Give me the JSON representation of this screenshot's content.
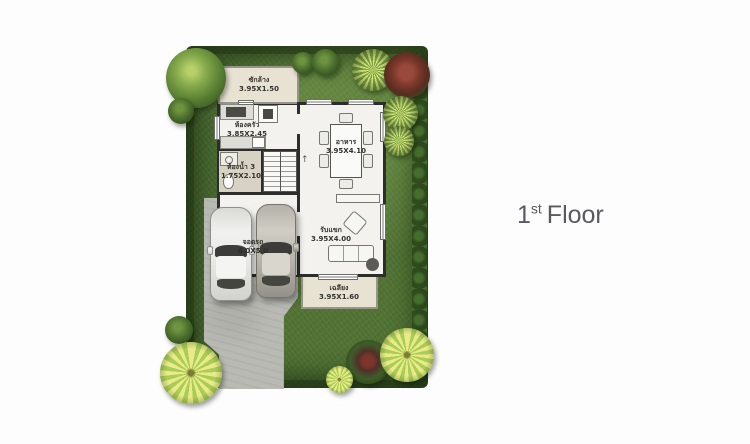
{
  "floor_label": {
    "number": "1",
    "ordinal": "st",
    "word": "Floor"
  },
  "rooms": {
    "laundry": {
      "name": "ซักล้าง",
      "size": "3.95X1.50"
    },
    "kitchen": {
      "name": "ห้องครัว",
      "size": "3.85X2.45"
    },
    "bathroom": {
      "name": "ห้องน้ำ 3",
      "size": "1.75X2.10"
    },
    "dining": {
      "name": "อาหาร",
      "size": "3.95X4.10"
    },
    "living": {
      "name": "รับแขก",
      "size": "3.95X4.00"
    },
    "porch": {
      "name": "เฉลียง",
      "size": "3.95X1.60"
    },
    "parking": {
      "name": "จอดรถ",
      "size": "6.0X5.0"
    }
  },
  "icons": {
    "stairs_up": "↑"
  },
  "colors": {
    "background": "#fdfdfd",
    "lawn": "#4a6a31",
    "hedge": "#2c451d",
    "driveway": "#b9bab4",
    "room_floor": "#f3f2ee",
    "beige_floor": "#e8e2d3",
    "wall": "#2d2d2b",
    "floor_label_text": "#5a5a5e"
  }
}
